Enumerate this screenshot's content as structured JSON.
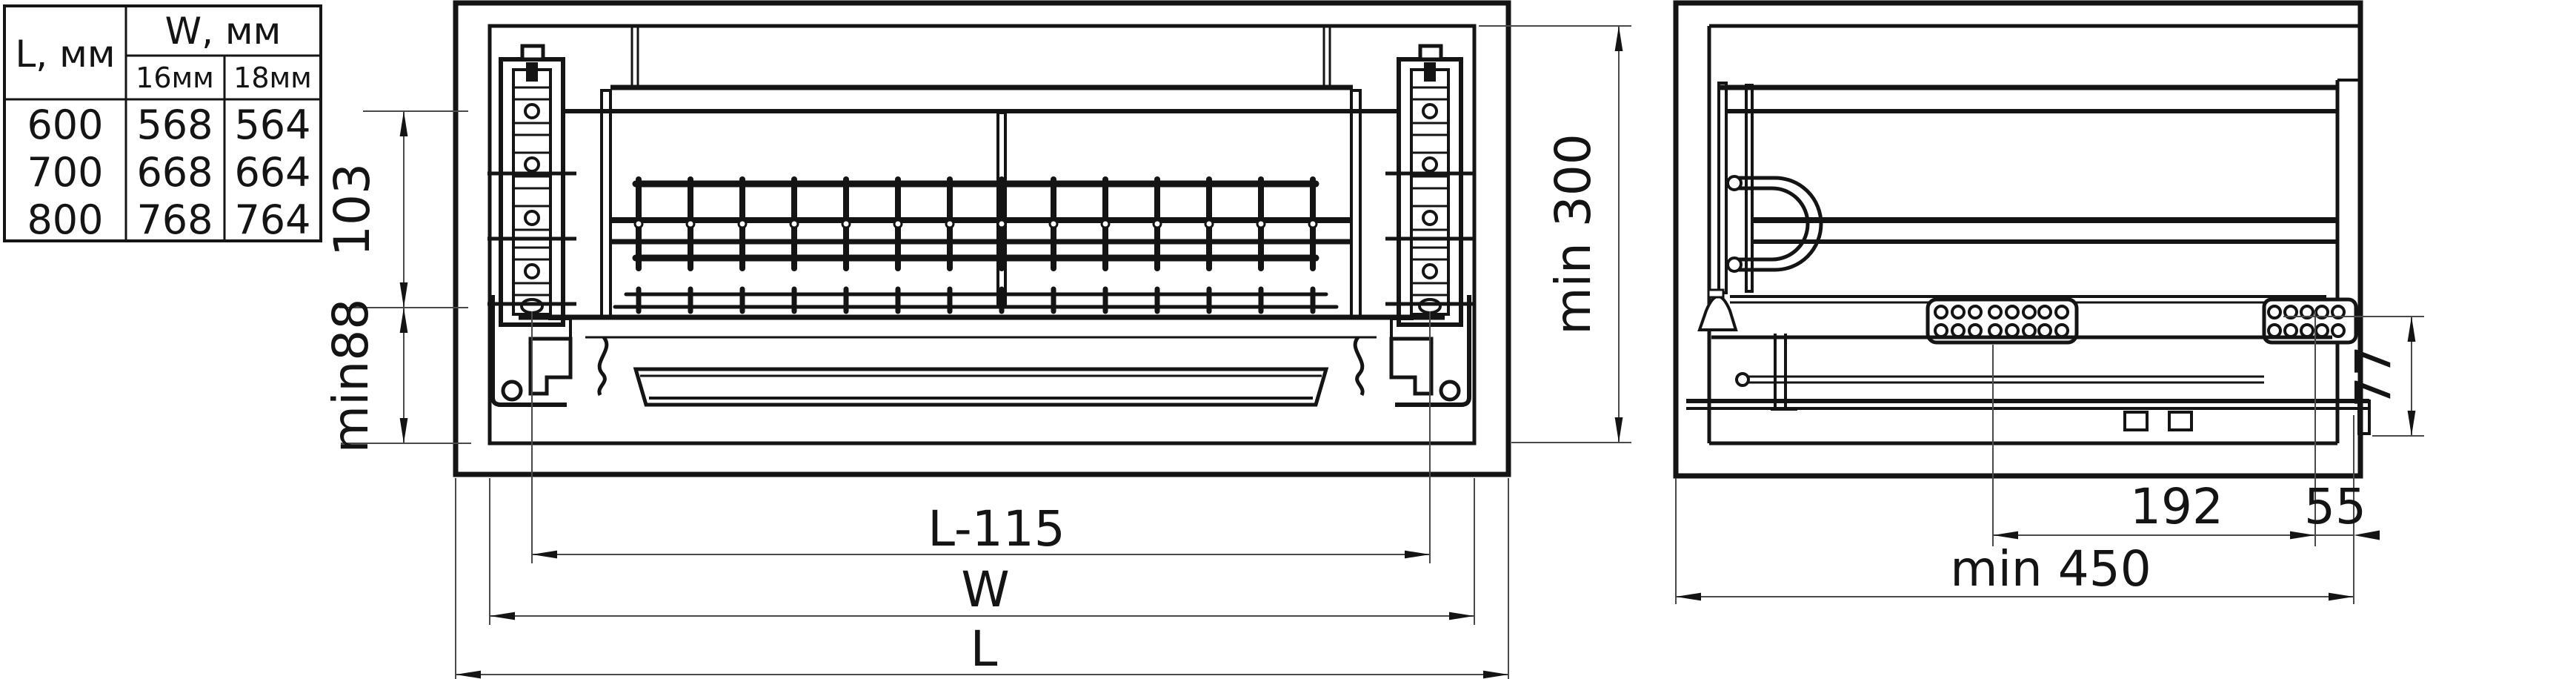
{
  "drawing": {
    "background": "#ffffff",
    "line_color": "#141414",
    "dim_line_color": "#4a4a4a"
  },
  "size_table": {
    "length_header": "L, мм",
    "width_header": "W, мм",
    "thickness_headers": [
      "16мм",
      "18мм"
    ],
    "rows": [
      {
        "length": "600",
        "width_16": "568",
        "width_18": "564"
      },
      {
        "length": "700",
        "width_16": "668",
        "width_18": "664"
      },
      {
        "length": "800",
        "width_16": "768",
        "width_18": "764"
      }
    ]
  },
  "front_view": {
    "dim_rack_zone_height": "103",
    "dim_bottom_clearance": "min88",
    "dim_mounting_span": "L-115",
    "dim_unit_width": "W",
    "dim_cabinet_width": "L"
  },
  "side_view": {
    "dim_inner_height": "min 300",
    "dim_runner_height": "77",
    "dim_runner_length": "192",
    "dim_back_offset": "55",
    "dim_min_depth": "min 450"
  }
}
